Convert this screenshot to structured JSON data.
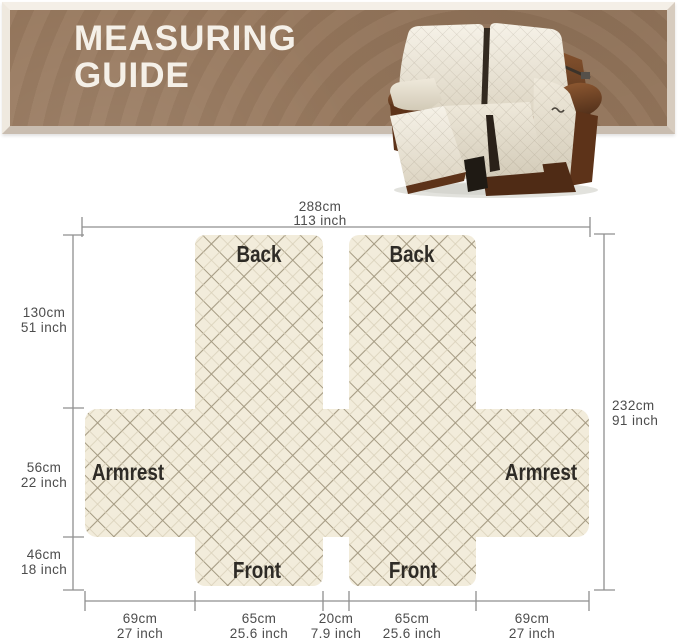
{
  "header": {
    "title_line1": "MEASURING",
    "title_line2": "GUIDE"
  },
  "diagram": {
    "panels": {
      "back_left": "Back",
      "back_right": "Back",
      "armrest_left": "Armrest",
      "armrest_right": "Armrest",
      "front_left": "Front",
      "front_right": "Front"
    },
    "measurements": {
      "top": {
        "cm": "288cm",
        "inch": "113 inch"
      },
      "left": [
        {
          "cm": "130cm",
          "inch": "51 inch"
        },
        {
          "cm": "56cm",
          "inch": "22 inch"
        },
        {
          "cm": "46cm",
          "inch": "18 inch"
        }
      ],
      "right": {
        "cm": "232cm",
        "inch": "91 inch"
      },
      "bottom": [
        {
          "cm": "69cm",
          "inch": "27 inch"
        },
        {
          "cm": "65cm",
          "inch": "25.6 inch"
        },
        {
          "cm": "20cm",
          "inch": "7.9 inch"
        },
        {
          "cm": "65cm",
          "inch": "25.6 inch"
        },
        {
          "cm": "69cm",
          "inch": "27 inch"
        }
      ]
    }
  },
  "colors": {
    "banner_brown": "#97785d",
    "banner_frame": "#e9e1d6",
    "fabric": "#f2ecdb",
    "quilt_line_major": "#a59b83",
    "quilt_line_minor": "#d9d1ba",
    "dimension_line": "#8f8f8f",
    "dimension_text": "#4c4c4c",
    "panel_text": "#2e2b26",
    "sofa_leather": "#6e3f1f",
    "sofa_cover": "#efe9db"
  }
}
